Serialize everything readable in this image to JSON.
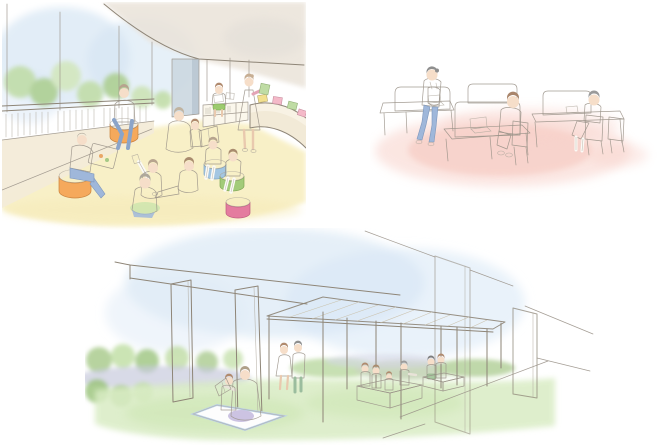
{
  "page": {
    "background": "#FFFFFF",
    "title": "Watercolor concept illustrations of reading and gathering spaces",
    "line_color": "#8E8577"
  },
  "scenes": [
    {
      "id": "terrace-reading",
      "name": "Terrace reading area with people on poufs",
      "description": "Glass-walled terrace with balustrade; adults and children read picture books sitting on round poufs and the pale-yellow floor; a woman in a pink dress stands at a low curved bookshelf.",
      "people_count": 11,
      "palette": {
        "sky": "#D5E6F4",
        "foliage": "#BFDCA4",
        "ceiling": "#EAE3D9",
        "floor": "#F8EFC2",
        "wall": "#F2EAD7",
        "column": "#CBD7E0",
        "pouf_orange": "#F2A155",
        "pouf_green": "#A2CB79",
        "pouf_blue": "#A3C6E2",
        "pouf_pink": "#E47C9F",
        "dress_pink": "#F5B3C5",
        "shirt_salmon": "#F2A8A3",
        "top_lavender": "#C9C3E0",
        "top_yellow": "#F0E3A2",
        "denim": "#9FB7DA",
        "book_blue": "#C6DDD3",
        "book_yellow": "#F2E08E",
        "book_green": "#BFDCA4"
      }
    },
    {
      "id": "study-carrels",
      "name": "Study desks with privacy partitions",
      "description": "Three carrel desks with tall cream partitions on a soft pink floor; two people work at laptops while a visitor with a salmon tote bag walks past.",
      "people_count": 3,
      "palette": {
        "floor": "#F6C9C2",
        "partition": "#F4EBCB",
        "desk": "#F6EFD2",
        "chair": "#F0E7C4",
        "pants_mint": "#AFD9B8",
        "top_lavender": "#CBC5E1",
        "bag_salmon": "#F4A89E",
        "denim": "#9FB7DA",
        "laptop": "#FFFFFF"
      }
    },
    {
      "id": "park-pavilion",
      "name": "Park pavilion under an elevated structure",
      "description": "Open lawn beneath concrete columns and a slatted pergola canopy; a parent and child read on a picnic blanket, a couple strolls, and children play at terracotta sand decks near translucent wall panels.",
      "people_count": 10,
      "palette": {
        "sky": "#D7E7F5",
        "grass": "#D9ECC4",
        "hedge": "#AACB8E",
        "water": "#C8CADD",
        "canopy": "#EBE4D2",
        "canopy_hatch": "#C9BFA8",
        "sandbox_top": "#F0B68E",
        "sandbox_front": "#DD9668",
        "blanket_edge": "#BDD3E8",
        "cushion_purple": "#C6BCDF",
        "dress_pink": "#F3B3C2",
        "pants_green": "#9BBD9E",
        "column": "#FFFFFF"
      }
    }
  ]
}
